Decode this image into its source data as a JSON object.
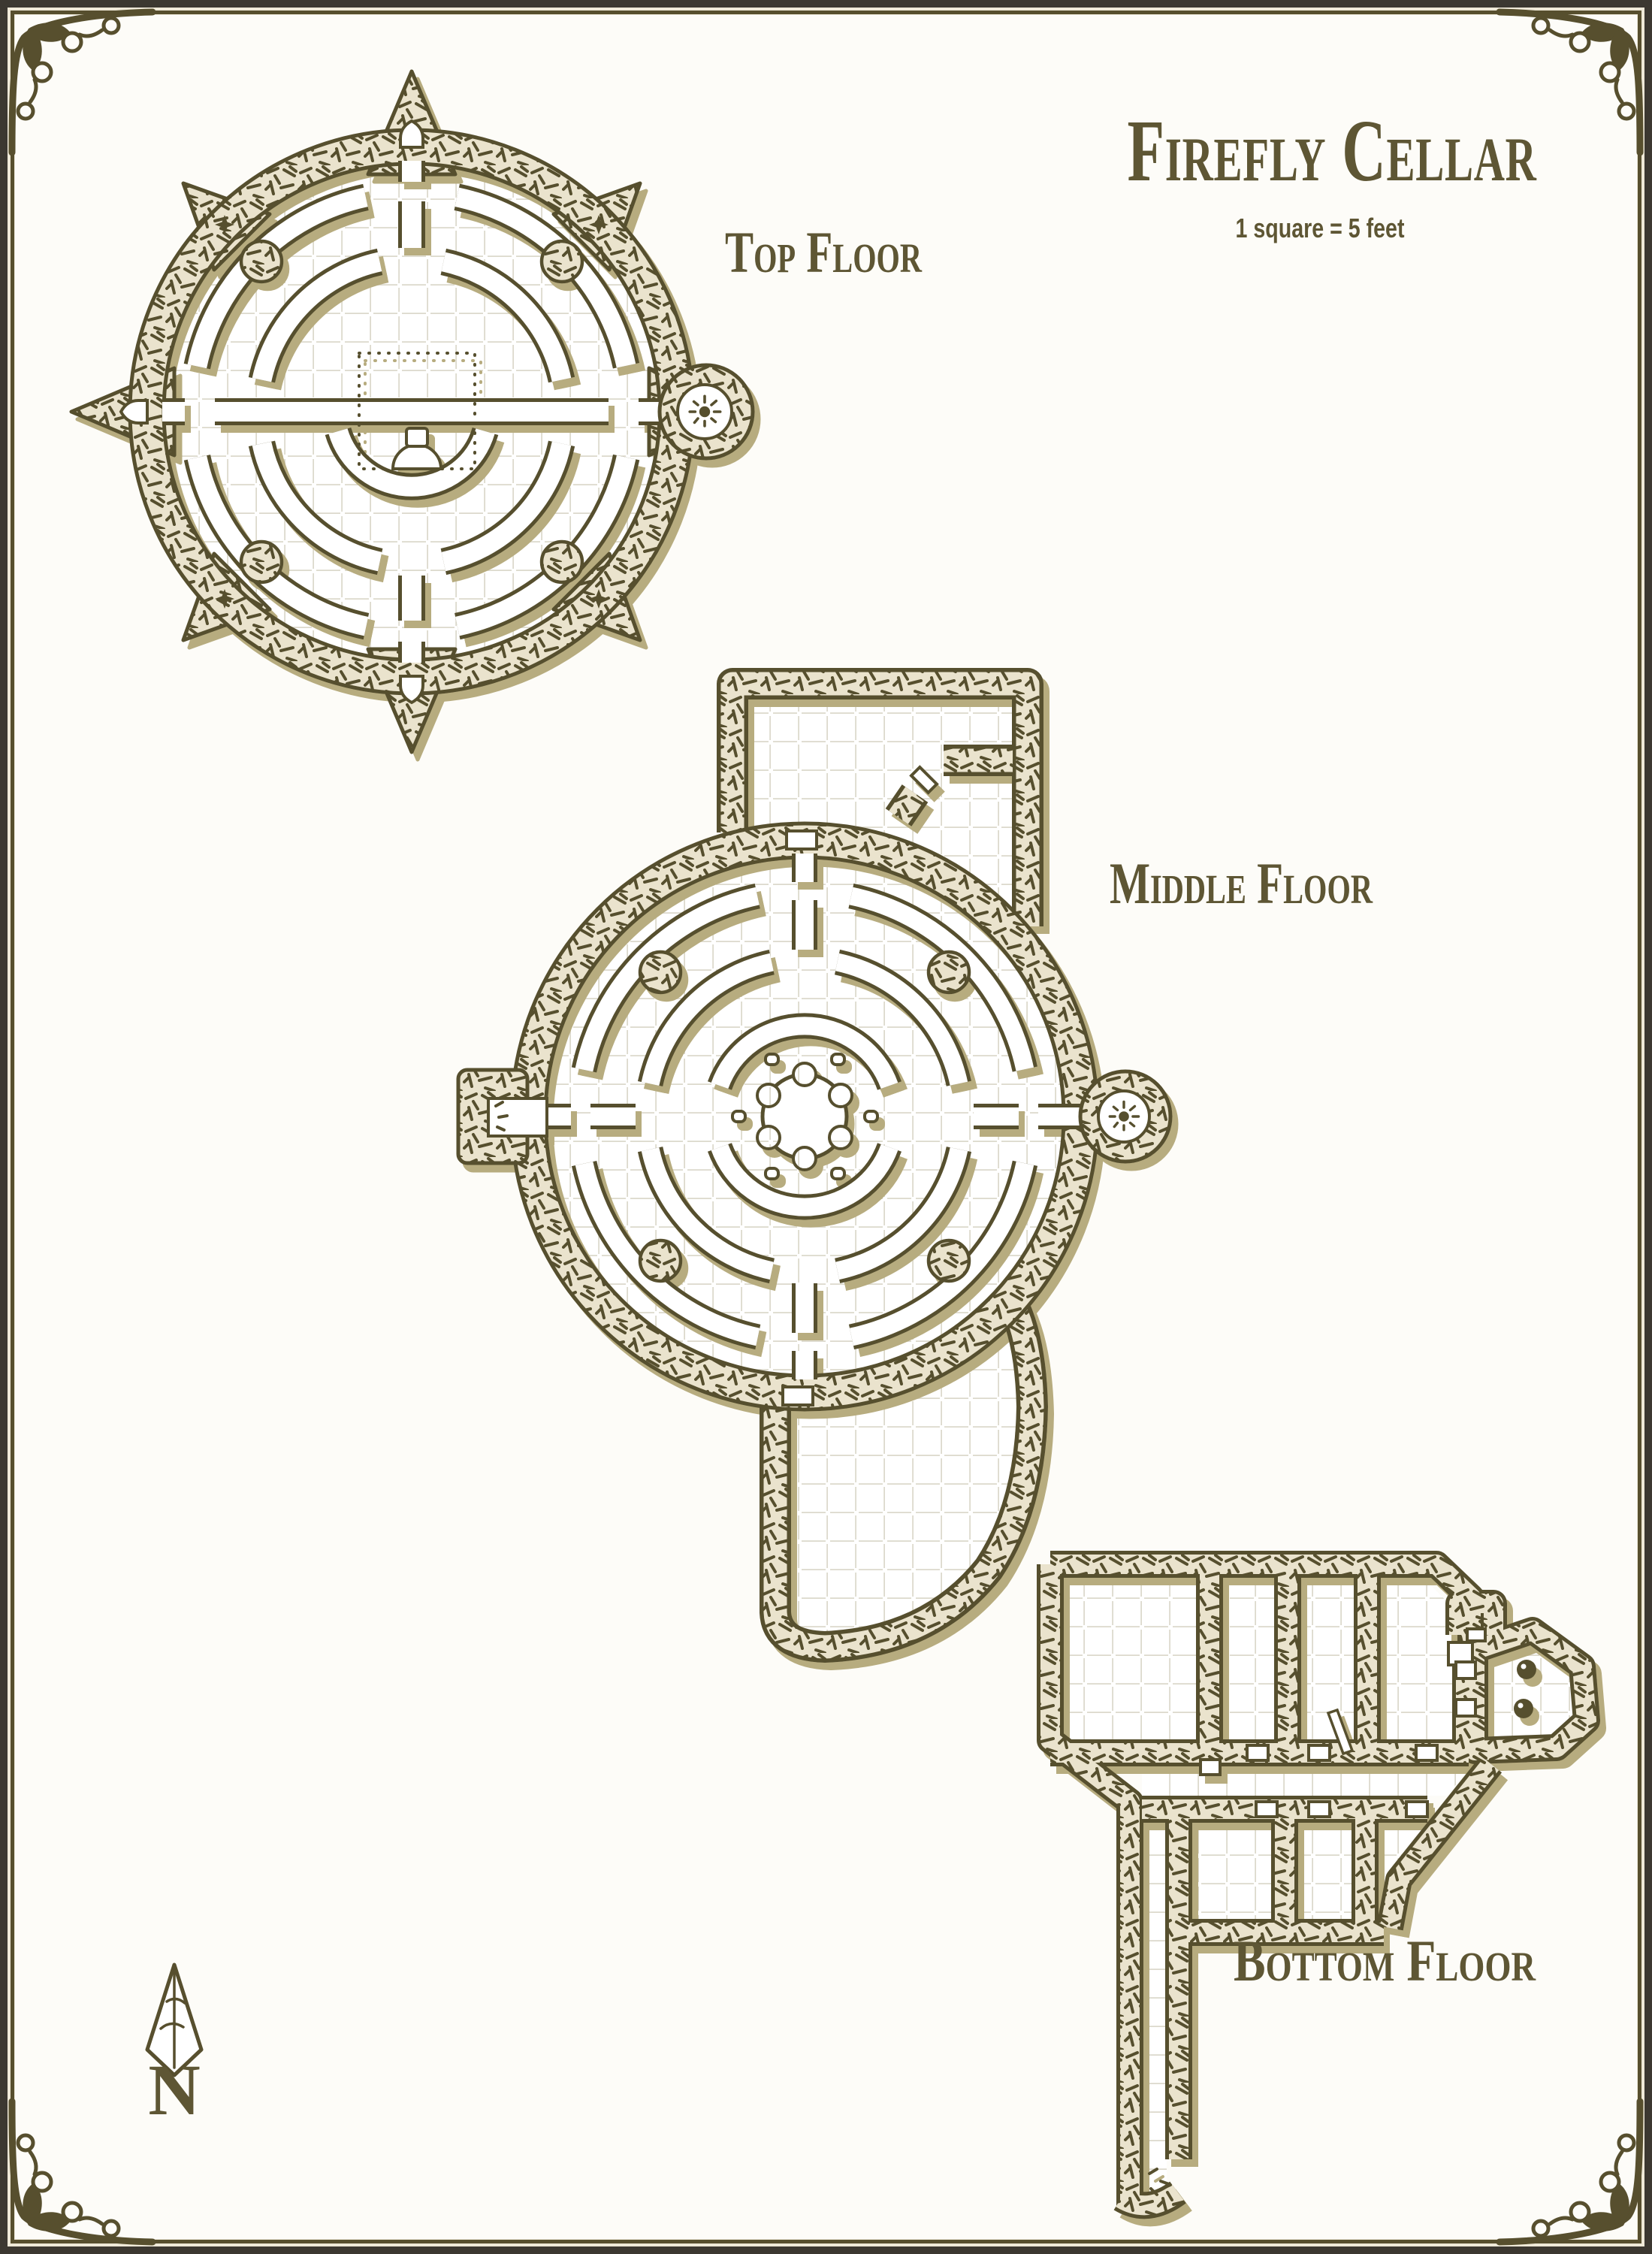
{
  "header": {
    "title": "Firefly Cellar",
    "scale_note": "1 square = 5 feet"
  },
  "floors": [
    {
      "id": "top",
      "label": "Top Floor"
    },
    {
      "id": "middle",
      "label": "Middle Floor"
    },
    {
      "id": "bottom",
      "label": "Bottom Floor"
    }
  ],
  "compass": {
    "label": "N",
    "direction": "north"
  },
  "palette": {
    "ink": "#574f2e",
    "text": "#5e5634",
    "paper": "#ffffff",
    "page": "#fdfcf8",
    "wall_fill": "#eae3cd",
    "shadow": "#b7ac7f",
    "grid": "#dcd9cc",
    "frame_dark": "#3c3831",
    "frame_cream": "#efe9d8"
  },
  "features": {
    "top_floor": {
      "shape": "circular chamber with 8 outer spikes",
      "spikes": 8,
      "concentric_ring_walls": 2,
      "inner_arc_walls": 1,
      "pillars": 4,
      "wall_stars": 4,
      "arched_doors": 3,
      "east_alcove_brazier": 1,
      "central_room": "dotted square with dais and altar"
    },
    "middle_floor": {
      "shape": "circular chamber with rectangular north room and curved south room",
      "concentric_ring_walls": 2,
      "inner_arc_walls": 2,
      "pillars": 4,
      "braziers": 2,
      "central_feature": "six-lobed gear dais with 6 seats",
      "doors": 4
    },
    "bottom_floor": {
      "shape": "rectilinear cellar complex",
      "rooms_upper_row": 4,
      "rooms_lower_row": 3,
      "octagonal_room": 1,
      "barrels": 2,
      "long_corridor": "runs south to map edge",
      "doors": 10
    }
  }
}
